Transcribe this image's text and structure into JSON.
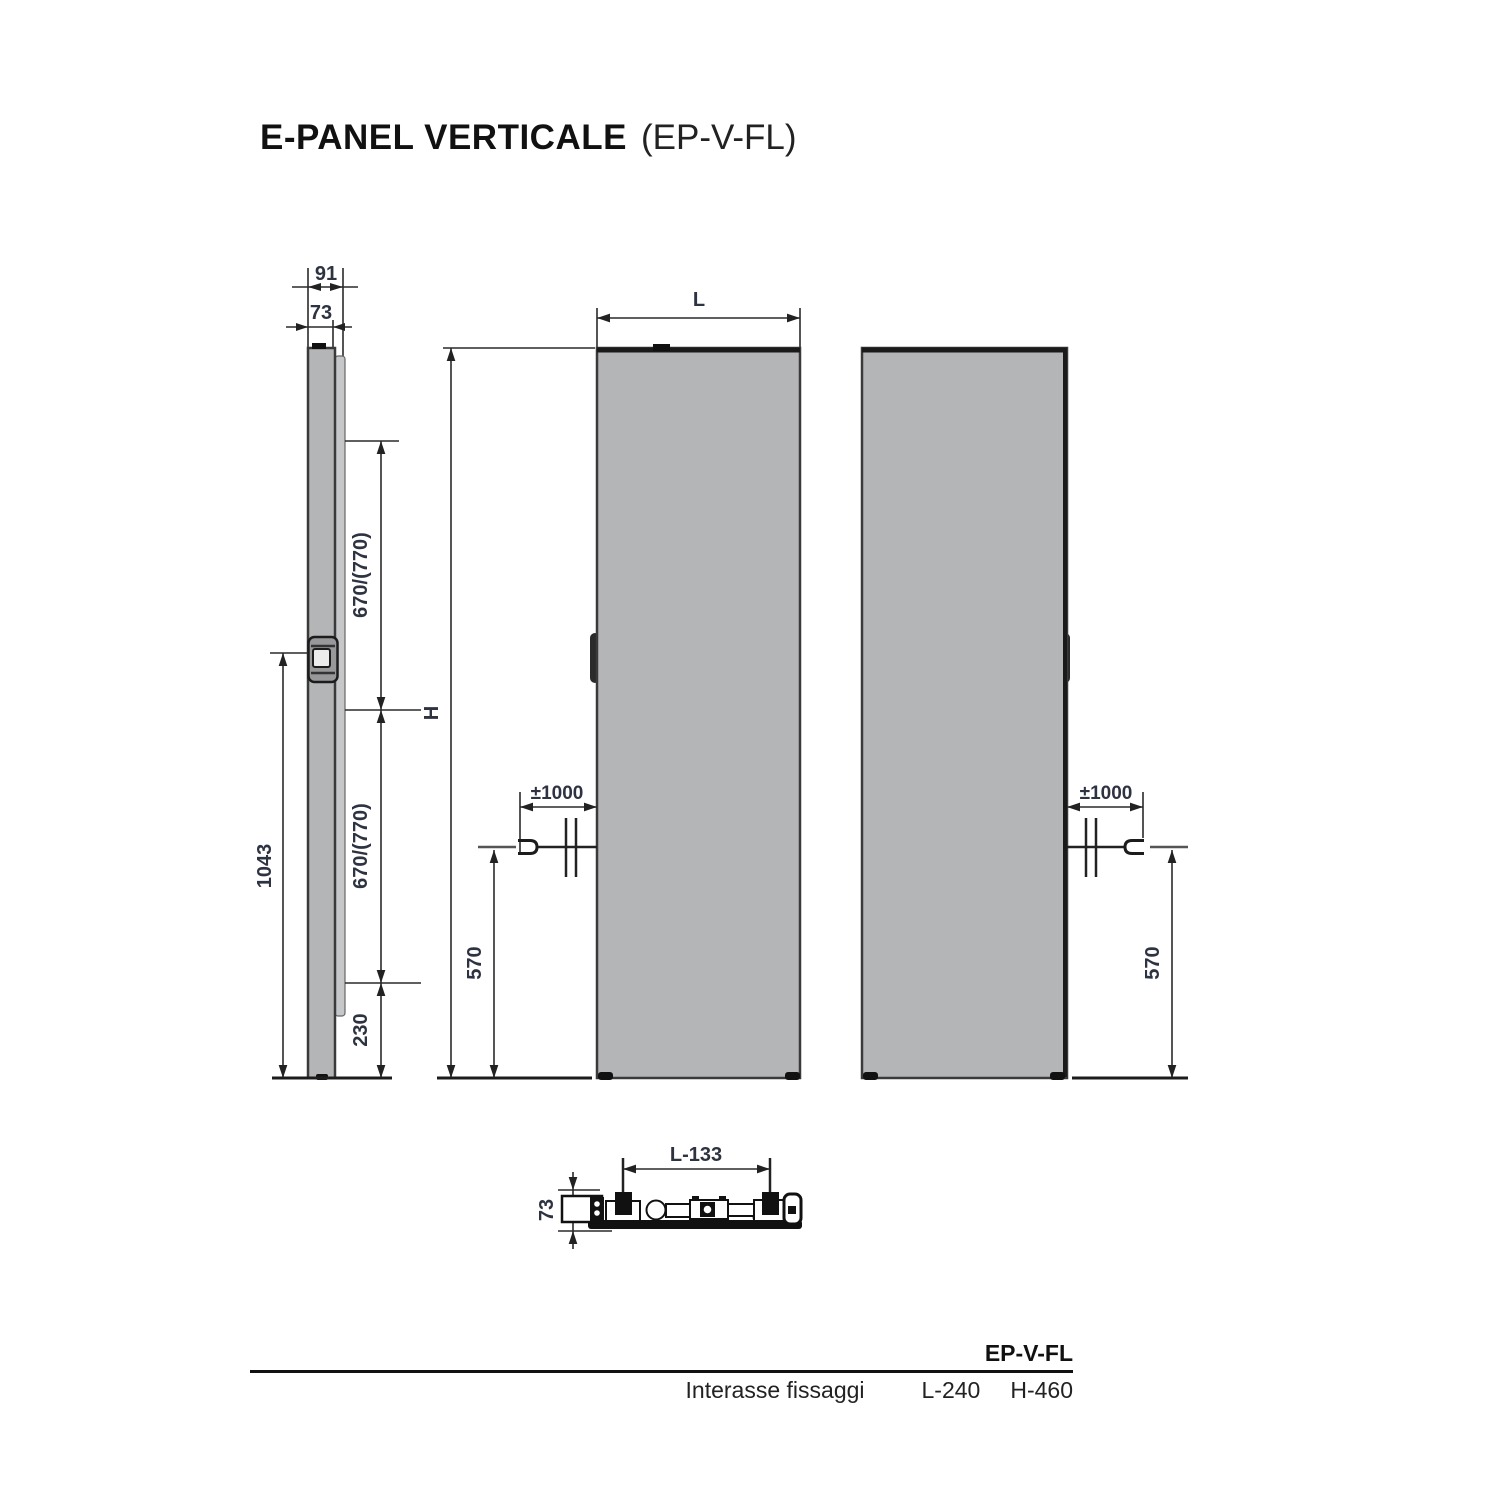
{
  "title": {
    "main": "E-PANEL VERTICALE",
    "code": "(EP-V-FL)"
  },
  "colors": {
    "panel_fill": "#b4b5b7",
    "bracket_fill": "#c6c7c9",
    "line": "#2a2a2a",
    "dim_text": "#2e3342",
    "black": "#111111",
    "background": "#ffffff"
  },
  "side_view": {
    "dim_depth_total": "91",
    "dim_depth_body": "73",
    "dim_upper_span": "670/(770)",
    "dim_lower_span": "670/(770)",
    "dim_control_height": "1043",
    "dim_bottom_offset": "230"
  },
  "front_view": {
    "dim_width": "L",
    "dim_height": "H",
    "dim_cable_length": "±1000",
    "dim_cable_height": "570"
  },
  "rear_view": {
    "dim_cable_length": "±1000",
    "dim_cable_height": "570"
  },
  "section_view": {
    "dim_fixing_span": "L-133",
    "dim_depth": "73"
  },
  "spec_table": {
    "model": "EP-V-FL",
    "row_label": "Interasse fissaggi",
    "l_value": "L-240",
    "h_value": "H-460"
  }
}
